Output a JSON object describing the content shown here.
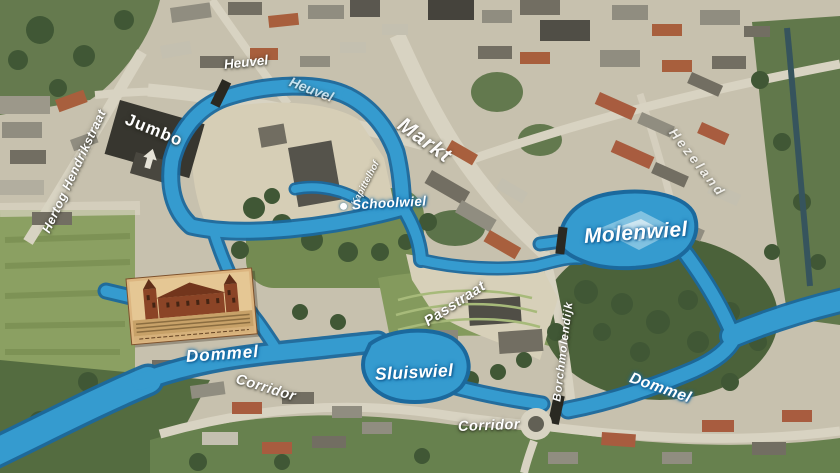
{
  "map": {
    "type": "aerial-overlay-map",
    "colors": {
      "water_fill": "#2f9ad2",
      "water_edge": "#14669e",
      "water_light": "#7fc3e5",
      "label_text": "#ffffff",
      "label_halo_water": "#1a6fa8"
    },
    "labels": {
      "jumbo": "Jumbo",
      "hertog_hendrikstraat": "Hertog Hendrikstraat",
      "heuvel_a": "Heuvel",
      "heuvel_b": "Heuvel",
      "markt": "Markt",
      "kapittelhof": "Kapittelhof",
      "schoolwiel": "Schoolwiel",
      "molenwiel": "Molenwiel",
      "hezeland": "Hezeland",
      "borchmolendijk": "Borchmolendijk",
      "passtraat": "Passtraat",
      "dommel_west": "Dommel",
      "corridor_west": "Corridor",
      "sluiswiel": "Sluiswiel",
      "corridor_east": "Corridor",
      "dommel_east": "Dommel"
    }
  }
}
